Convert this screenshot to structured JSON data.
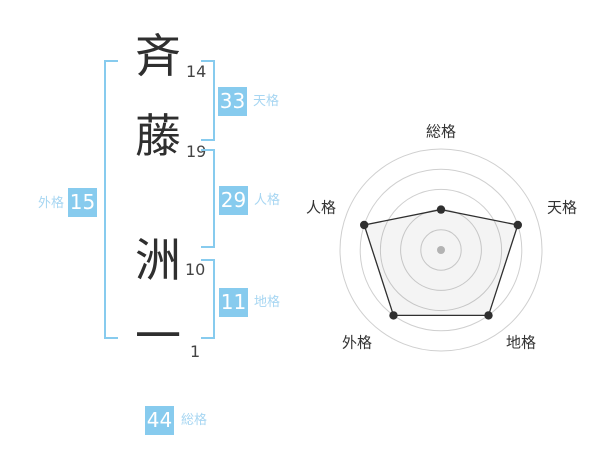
{
  "name_analysis": {
    "characters": [
      {
        "char": "斉",
        "strokes": "14"
      },
      {
        "char": "藤",
        "strokes": "19"
      },
      {
        "char": "洲",
        "strokes": "10"
      },
      {
        "char": "一",
        "strokes": "1"
      }
    ],
    "scores": {
      "tenkaku": {
        "value": "33",
        "label": "天格"
      },
      "jinkaku": {
        "value": "29",
        "label": "人格"
      },
      "chikaku": {
        "value": "11",
        "label": "地格"
      },
      "gaikaku": {
        "value": "15",
        "label": "外格"
      },
      "soukaku": {
        "value": "44",
        "label": "総格"
      }
    }
  },
  "colors": {
    "accent": "#87CBEE",
    "label_text": "#A7D6F2",
    "ink": "#2f2f2f",
    "grid": "#cfcfcf"
  },
  "chart_data": {
    "type": "radar",
    "axes": [
      "総格",
      "天格",
      "地格",
      "外格",
      "人格"
    ],
    "series": [
      {
        "name": "運勢",
        "values": [
          40,
          80,
          80,
          80,
          80
        ]
      }
    ],
    "max": 100,
    "rings": 5,
    "grid": "concentric-circles",
    "spokes": false,
    "legend": false,
    "title": ""
  }
}
